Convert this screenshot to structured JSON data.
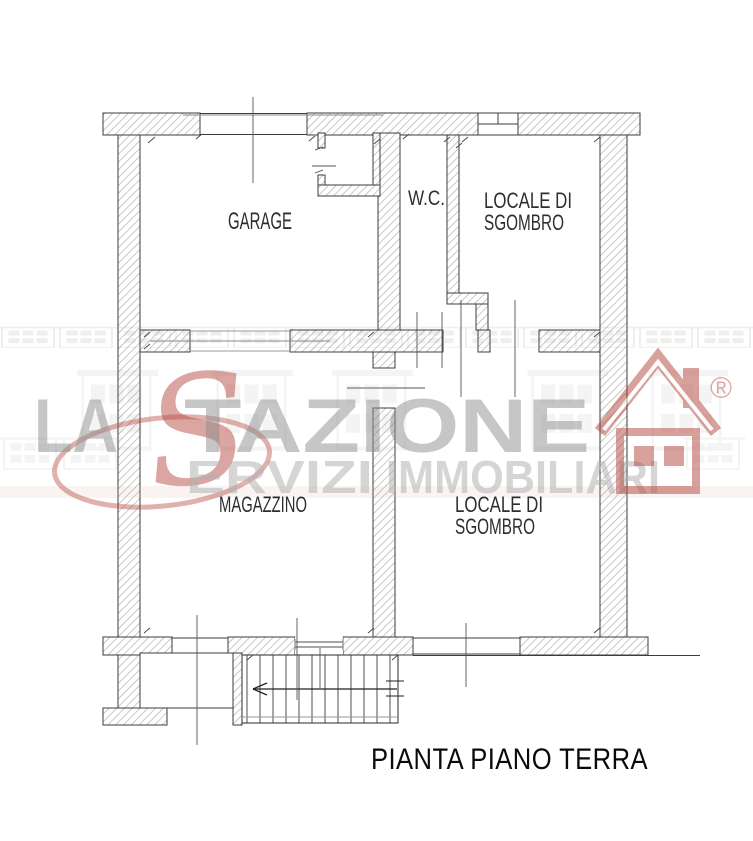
{
  "page": {
    "background": "#ffffff"
  },
  "plan": {
    "title": "PIANTA PIANO TERRA",
    "rooms": [
      {
        "label": "GARAGE"
      },
      {
        "label": "W.C."
      },
      {
        "label_line1": "LOCALE DI",
        "label_line2": "SGOMBRO"
      },
      {
        "label": "MAGAZZINO"
      },
      {
        "label_line1": "LOCALE DI",
        "label_line2": "SGOMBRO"
      }
    ],
    "stairs": {
      "steps": 12,
      "direction": "left"
    }
  },
  "watermark": {
    "brand_prefix": "LA",
    "brand_script_initial": "S",
    "brand_suffix": "TAZIONE",
    "tagline_word1_rest": "ERVIZI",
    "tagline_word2": "IMMOBILIARI",
    "registered_mark": "®",
    "icons": {
      "logo": "house-logo-icon",
      "stairs_direction": "arrow-left-icon"
    },
    "colors": {
      "brand_red": "#b5453c",
      "brand_gray": "#9a9a9a",
      "wall_line": "#3c3c3c"
    }
  }
}
